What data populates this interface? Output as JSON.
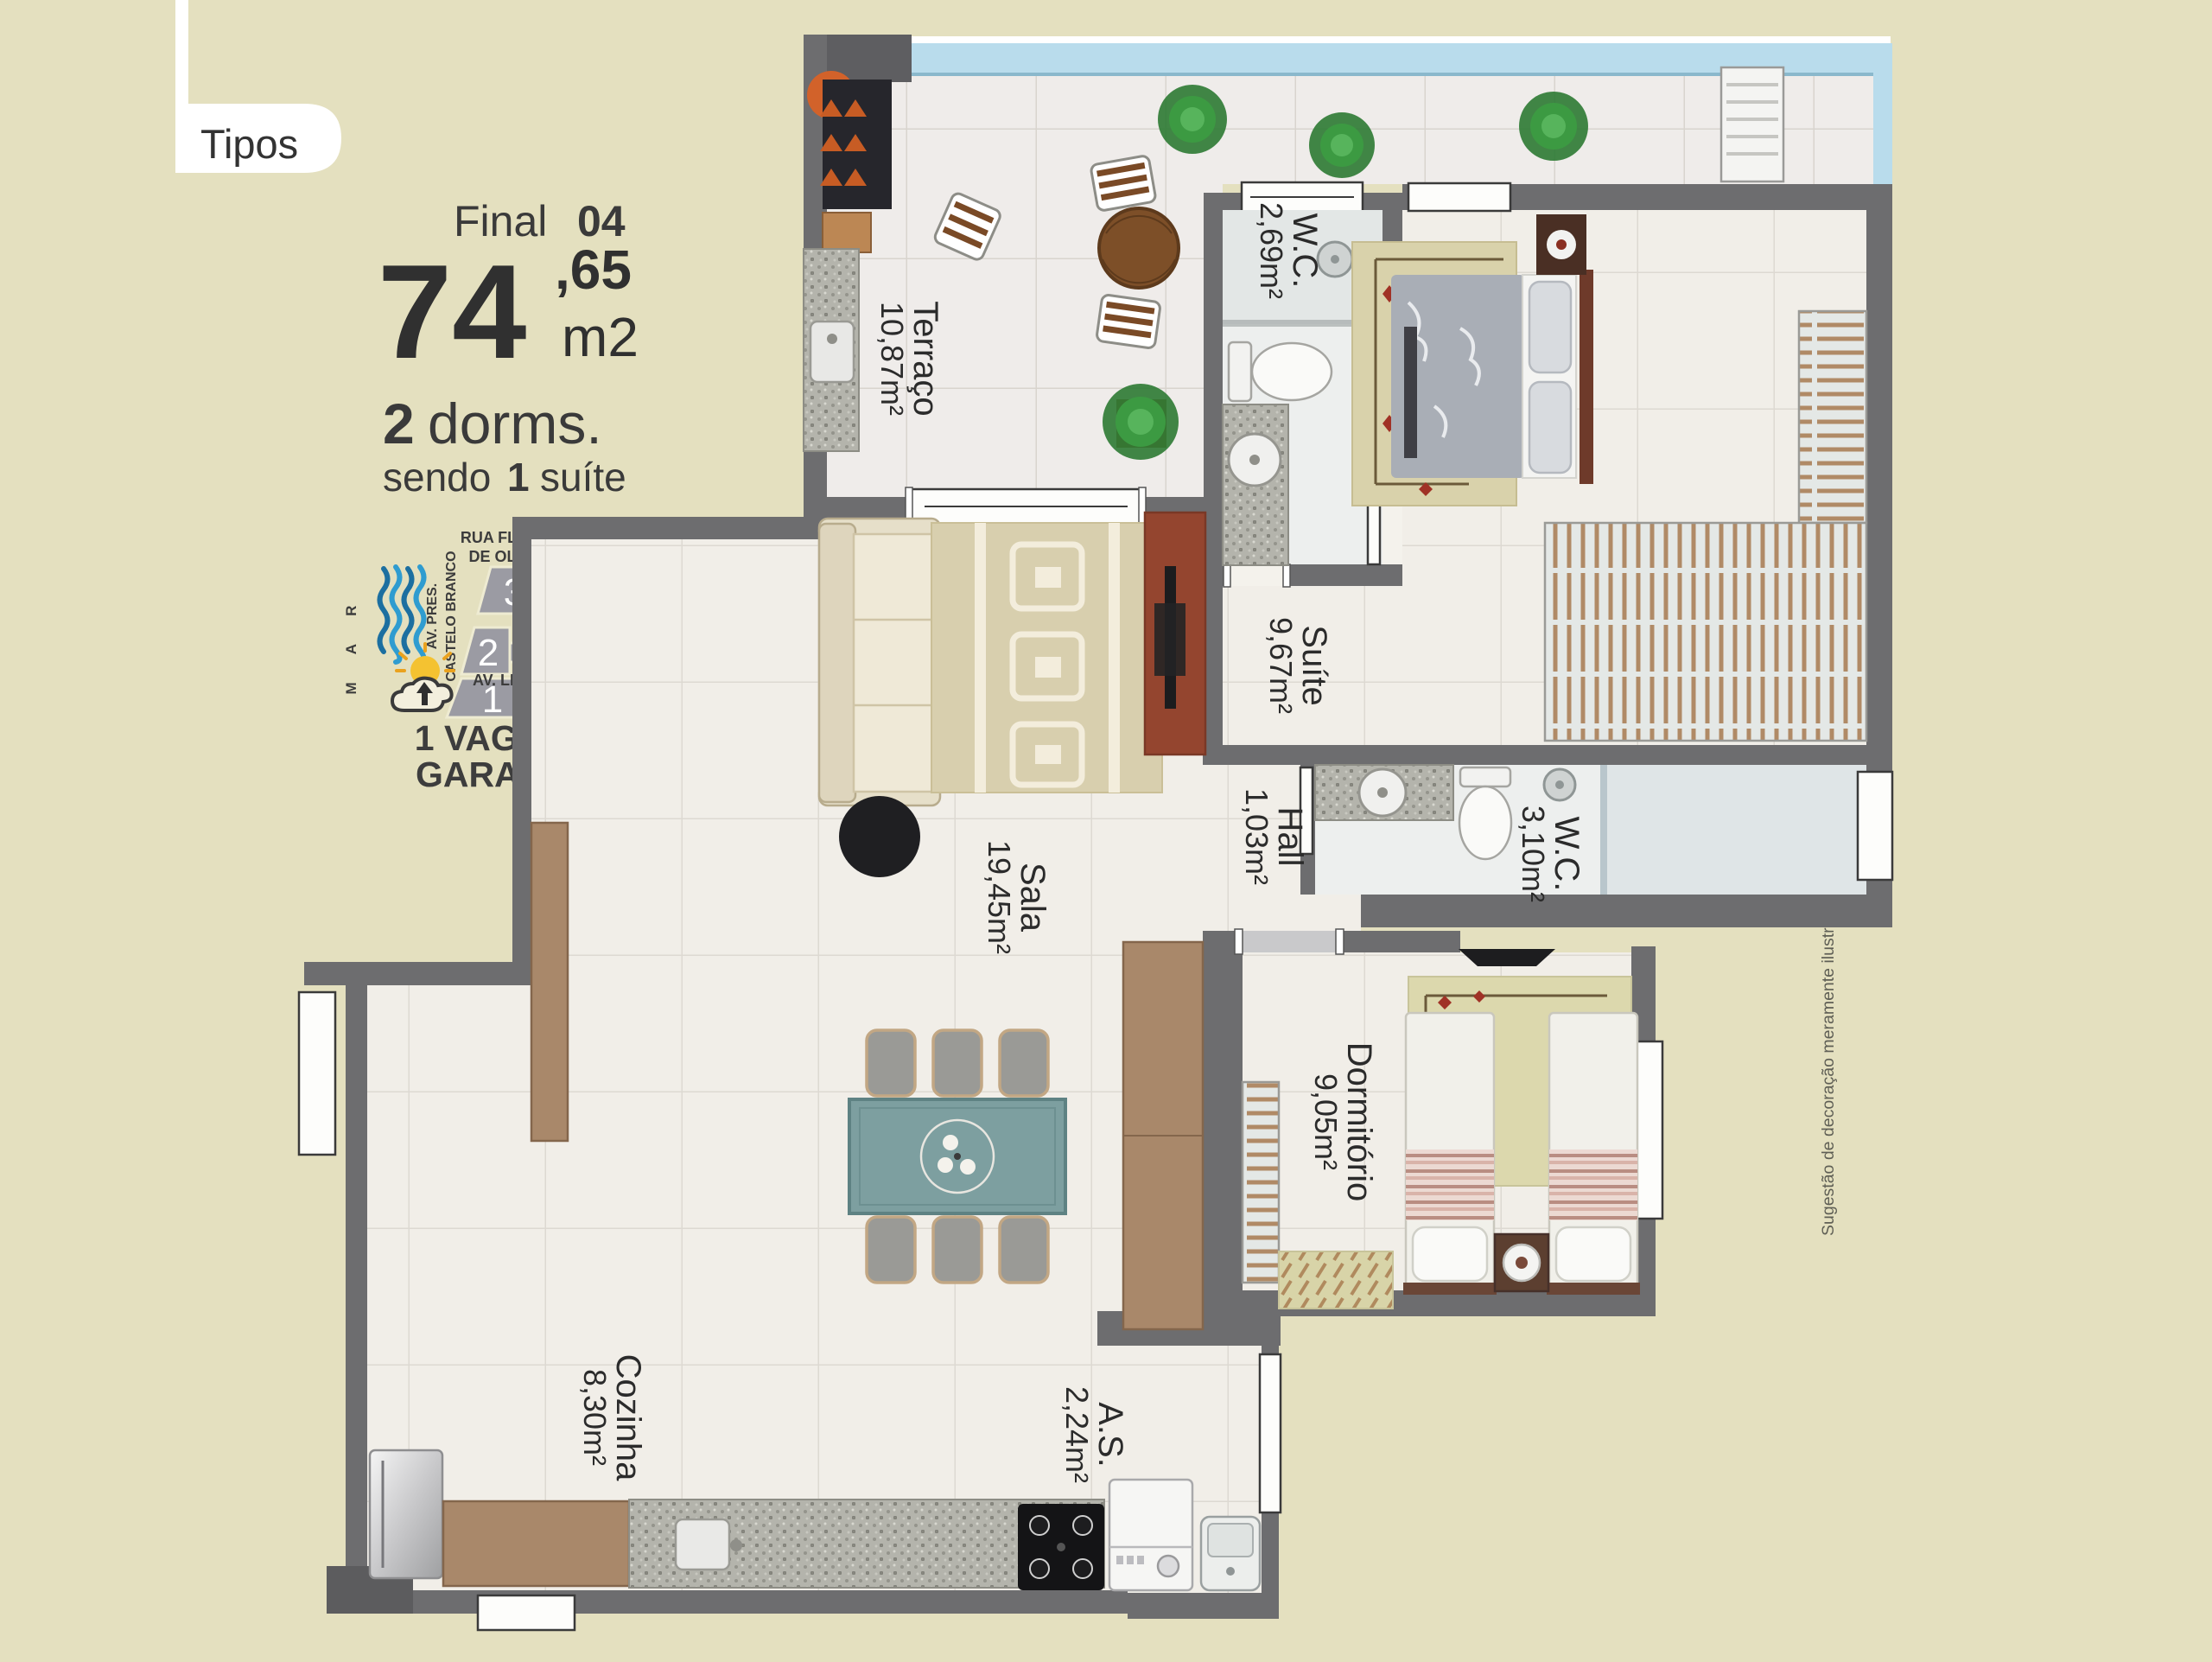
{
  "page": {
    "tab_label": "Tipos"
  },
  "unit": {
    "final_label": "Final",
    "final_number": "04",
    "area_integer": "74",
    "area_decimal": ",65",
    "area_unit": "m2",
    "dorms_number": "2",
    "dorms_label": "dorms.",
    "suite_prefix": "sendo",
    "suite_number": "1",
    "suite_suffix": "suíte",
    "garage_line1": "1 VAGA DE",
    "garage_line2": "GARAGEM"
  },
  "map": {
    "street_top_line1": "RUA FLAUSINA",
    "street_top_line2": "DE OLIVEIRA",
    "sea_label": "M A R",
    "avenue_west_line1": "AV. PRES.",
    "avenue_west_line2": "CASTELO BRANCO",
    "street_right": "RUA ISIS",
    "avenue_bottom": "AV. LINCOLN",
    "blocks": [
      "1",
      "2",
      "3",
      "4",
      "5"
    ]
  },
  "rooms": {
    "terraco": {
      "name": "Terraço",
      "area": "10,87m²"
    },
    "wc_suite": {
      "name": "W.C.",
      "area": "2,69m²"
    },
    "suite": {
      "name": "Suíte",
      "area": "9,67m²"
    },
    "hall": {
      "name": "Hall",
      "area": "1,03m²"
    },
    "wc_social": {
      "name": "W.C.",
      "area": "3,10m²"
    },
    "sala": {
      "name": "Sala",
      "area": "19,45m²"
    },
    "dormitorio": {
      "name": "Dormitório",
      "area": "9,05m²"
    },
    "cozinha": {
      "name": "Cozinha",
      "area": "8,30m²"
    },
    "area_servico": {
      "name": "A.S.",
      "area": "2,24m²"
    }
  },
  "disclaimer": "Sugestão de decoração meramente ilustrativa, os móveis e revestimentos não fazem parte integrante do contrato de compra e venda.",
  "colors": {
    "background": "#e4e0bf",
    "wall": "#6d6d6f",
    "wall_dark": "#5c5c5e",
    "floor": "#f1eee8",
    "balcony_glass": "#b9dcec",
    "map_block": "#9b9ba3",
    "map_block_highlight": "#55555b",
    "water": "#2796c8",
    "sun": "#f4c231",
    "wood": "#a9886a",
    "tv_stand_red": "#94452f",
    "text": "#3a3a3a"
  }
}
